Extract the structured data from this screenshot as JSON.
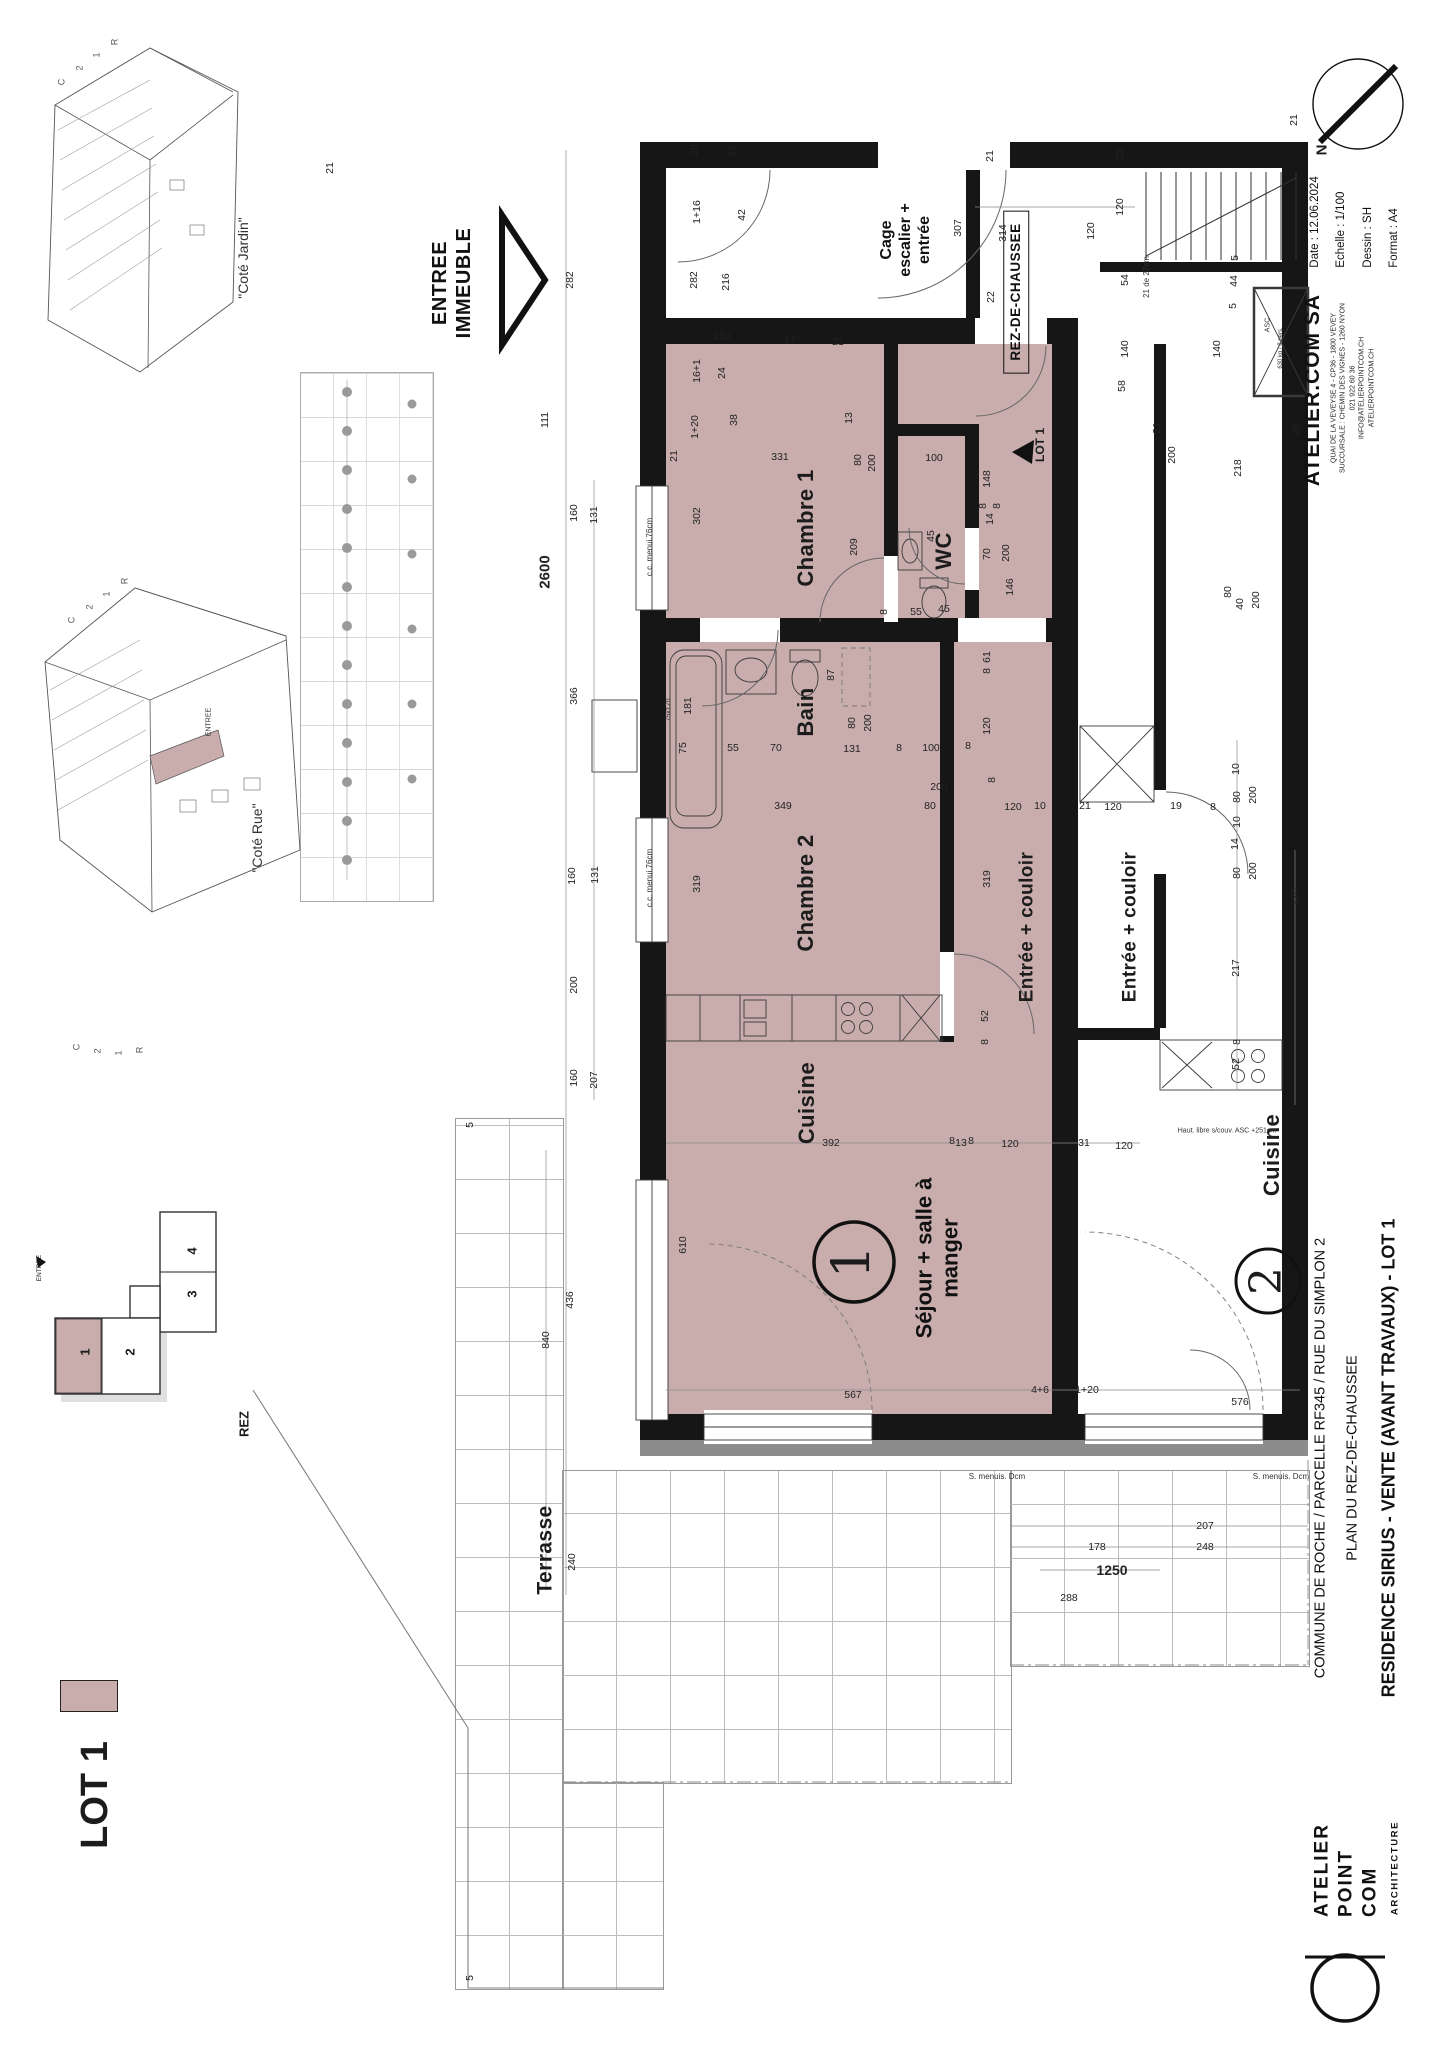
{
  "colors": {
    "lot": "#c9adad",
    "wall": "#161616",
    "band": "#8c8c8c"
  },
  "title_block": {
    "firm": "ATELIER.COM SA",
    "address_line1": "QUAI DE LA VEVEYSE 4 - CP36 - 1800 VEVEY",
    "address_line2": "SUCCURSALE : CHEMIN DES VIGNES - 1260 NYON",
    "address_line3": "021 922 60 36",
    "address_line4": "INFO@ATELIERPOINTCOM.CH",
    "address_line5": "ATELIERPOINTCOM.CH",
    "date": "Date : 12.06.2024",
    "scale": "Echelle : 1/100",
    "drawn": "Dessin : SH",
    "format": "Format : A4"
  },
  "project": {
    "line1": "COMMUNE DE ROCHE / PARCELLE RF345 / RUE DU SIMPLON 2",
    "line2": "PLAN DU REZ-DE-CHAUSSEE",
    "line3": "RESIDENCE SIRIUS  -  VENTE (AVANT TRAVAUX) - LOT 1"
  },
  "logo": {
    "line1": "ATELIER",
    "line2": "POINT",
    "line3": "COM",
    "sub": "ARCHITECTURE"
  },
  "plan": {
    "level_box": "REZ-DE-CHAUSSEE",
    "cage_line1": "Cage",
    "cage_line2": "escalier +",
    "cage_line3": "entrée",
    "sejour_line1": "Séjour + salle à",
    "sejour_line2": "manger",
    "entrance_line1": "ENTREE",
    "entrance_line2": "IMMEUBLE"
  },
  "labels": {
    "rooms": [
      {
        "t": "Chambre 1",
        "x": 806,
        "y": 528
      },
      {
        "t": "WC",
        "x": 944,
        "y": 551
      },
      {
        "t": "Bain",
        "x": 806,
        "y": 712
      },
      {
        "t": "Chambre 2",
        "x": 806,
        "y": 893
      },
      {
        "t": "Entrée + couloir",
        "x": 1027,
        "y": 927,
        "s": 19
      },
      {
        "t": "Entrée + couloir",
        "x": 1130,
        "y": 927,
        "s": 19
      },
      {
        "t": "Cuisine",
        "x": 807,
        "y": 1103
      },
      {
        "t": "Cuisine",
        "x": 1272,
        "y": 1155
      },
      {
        "t": "Terrasse",
        "x": 545,
        "y": 1550,
        "s": 21
      }
    ],
    "views": [
      {
        "t": "\"Coté Jardin\"",
        "x": 243,
        "y": 258
      },
      {
        "t": "\"Coté Rue\"",
        "x": 257,
        "y": 838
      },
      {
        "t": "ENTREE",
        "x": 209,
        "y": 722,
        "s": 7
      }
    ],
    "marks": [
      {
        "t": "C",
        "x": 62,
        "y": 82
      },
      {
        "t": "2",
        "x": 80,
        "y": 68
      },
      {
        "t": "1",
        "x": 97,
        "y": 55
      },
      {
        "t": "R",
        "x": 115,
        "y": 42
      },
      {
        "t": "C",
        "x": 72,
        "y": 620
      },
      {
        "t": "2",
        "x": 90,
        "y": 607
      },
      {
        "t": "1",
        "x": 107,
        "y": 594
      },
      {
        "t": "R",
        "x": 125,
        "y": 581
      },
      {
        "t": "C",
        "x": 77,
        "y": 1047
      },
      {
        "t": "2",
        "x": 98,
        "y": 1051
      },
      {
        "t": "1",
        "x": 119,
        "y": 1053
      },
      {
        "t": "R",
        "x": 140,
        "y": 1050
      }
    ],
    "keyplan": [
      {
        "t": "4",
        "x": 192,
        "y": 1251,
        "b": 1,
        "s": 13
      },
      {
        "t": "3",
        "x": 192,
        "y": 1294,
        "b": 1,
        "s": 13
      },
      {
        "t": "2",
        "x": 130,
        "y": 1352,
        "b": 1,
        "s": 13
      },
      {
        "t": "1",
        "x": 85,
        "y": 1352,
        "b": 1,
        "s": 13
      },
      {
        "t": "REZ",
        "x": 244,
        "y": 1424,
        "b": 1,
        "s": 13
      },
      {
        "t": "ENTREE",
        "x": 40,
        "y": 1268,
        "s": 6.5
      }
    ],
    "units": [
      {
        "t": "1",
        "x": 852,
        "y": 1262,
        "s": 52
      },
      {
        "t": "2",
        "x": 1267,
        "y": 1281,
        "s": 44
      }
    ],
    "tags": [
      {
        "t": "LOT 1",
        "x": 1040,
        "y": 445,
        "s": 12
      },
      {
        "t": "LOT 1",
        "x": 95,
        "y": 1795,
        "s": 38
      },
      {
        "t": "N",
        "x": 1322,
        "y": 150,
        "s": 15
      }
    ],
    "notes": [
      {
        "t": "c.c. menui.76cm",
        "x": 650,
        "y": 547
      },
      {
        "t": "c.c. menui.76cm",
        "x": 650,
        "y": 878
      },
      {
        "t": "75x170",
        "x": 669,
        "y": 710,
        "s": 7
      },
      {
        "t": "S. menuis. Dcm",
        "x": 997,
        "y": 1477,
        "h": 1
      },
      {
        "t": "S. menuis. Dcm",
        "x": 1281,
        "y": 1477,
        "h": 1
      },
      {
        "t": "Haut. libre s/couv. ASC +251cm",
        "x": 1227,
        "y": 1131,
        "s": 7,
        "h": 1
      },
      {
        "t": "21 de 27cm",
        "x": 1147,
        "y": 277
      },
      {
        "t": "ASC",
        "x": 1268,
        "y": 325,
        "s": 7
      },
      {
        "t": "630 kg / 8 pers.",
        "x": 1281,
        "y": 348,
        "s": 6
      }
    ],
    "dims": [
      {
        "t": "21",
        "x": 330,
        "y": 168
      },
      {
        "t": "282",
        "x": 570,
        "y": 280
      },
      {
        "t": "111",
        "x": 545,
        "y": 420
      },
      {
        "t": "160",
        "x": 574,
        "y": 513
      },
      {
        "t": "131",
        "x": 594,
        "y": 515
      },
      {
        "t": "366",
        "x": 574,
        "y": 696
      },
      {
        "t": "160",
        "x": 572,
        "y": 876
      },
      {
        "t": "131",
        "x": 595,
        "y": 875
      },
      {
        "t": "200",
        "x": 574,
        "y": 985
      },
      {
        "t": "160",
        "x": 574,
        "y": 1078
      },
      {
        "t": "207",
        "x": 594,
        "y": 1080
      },
      {
        "t": "436",
        "x": 570,
        "y": 1300
      },
      {
        "t": "840",
        "x": 546,
        "y": 1340
      },
      {
        "t": "2600",
        "x": 545,
        "y": 572,
        "b": 1,
        "s": 15
      },
      {
        "t": "240",
        "x": 572,
        "y": 1562
      },
      {
        "t": "5",
        "x": 470,
        "y": 1125
      },
      {
        "t": "5",
        "x": 470,
        "y": 1978
      },
      {
        "t": "20",
        "x": 694,
        "y": 150
      },
      {
        "t": "37",
        "x": 733,
        "y": 151
      },
      {
        "t": "1+16",
        "x": 697,
        "y": 212
      },
      {
        "t": "42",
        "x": 742,
        "y": 215
      },
      {
        "t": "282",
        "x": 694,
        "y": 280
      },
      {
        "t": "216",
        "x": 726,
        "y": 282
      },
      {
        "t": "250",
        "x": 722,
        "y": 336,
        "h": 1
      },
      {
        "t": "17",
        "x": 790,
        "y": 340,
        "h": 1
      },
      {
        "t": "21",
        "x": 838,
        "y": 342,
        "h": 1
      },
      {
        "t": "16+1",
        "x": 697,
        "y": 371
      },
      {
        "t": "24",
        "x": 722,
        "y": 373
      },
      {
        "t": "307",
        "x": 958,
        "y": 228
      },
      {
        "t": "314",
        "x": 1003,
        "y": 233
      },
      {
        "t": "22",
        "x": 991,
        "y": 297
      },
      {
        "t": "21",
        "x": 990,
        "y": 156
      },
      {
        "t": "21",
        "x": 1120,
        "y": 154
      },
      {
        "t": "120",
        "x": 1120,
        "y": 207
      },
      {
        "t": "120",
        "x": 1091,
        "y": 231
      },
      {
        "t": "54",
        "x": 1125,
        "y": 280
      },
      {
        "t": "44",
        "x": 1234,
        "y": 281
      },
      {
        "t": "5",
        "x": 1235,
        "y": 258
      },
      {
        "t": "5",
        "x": 1233,
        "y": 306
      },
      {
        "t": "140",
        "x": 1125,
        "y": 349
      },
      {
        "t": "140",
        "x": 1217,
        "y": 349
      },
      {
        "t": "21",
        "x": 1294,
        "y": 120
      },
      {
        "t": "26",
        "x": 1296,
        "y": 429
      },
      {
        "t": "31",
        "x": 1157,
        "y": 428
      },
      {
        "t": "58",
        "x": 1122,
        "y": 386
      },
      {
        "t": "200",
        "x": 1172,
        "y": 455
      },
      {
        "t": "218",
        "x": 1238,
        "y": 468
      },
      {
        "t": "80",
        "x": 1228,
        "y": 592
      },
      {
        "t": "40",
        "x": 1240,
        "y": 604
      },
      {
        "t": "200",
        "x": 1256,
        "y": 600
      },
      {
        "t": "1+20",
        "x": 695,
        "y": 427
      },
      {
        "t": "38",
        "x": 734,
        "y": 420
      },
      {
        "t": "21",
        "x": 674,
        "y": 456
      },
      {
        "t": "302",
        "x": 697,
        "y": 516
      },
      {
        "t": "331",
        "x": 780,
        "y": 457,
        "h": 1
      },
      {
        "t": "209",
        "x": 854,
        "y": 547
      },
      {
        "t": "13",
        "x": 849,
        "y": 418
      },
      {
        "t": "80",
        "x": 858,
        "y": 460
      },
      {
        "t": "200",
        "x": 872,
        "y": 463
      },
      {
        "t": "8",
        "x": 884,
        "y": 612
      },
      {
        "t": "100",
        "x": 934,
        "y": 458,
        "h": 1
      },
      {
        "t": "148",
        "x": 987,
        "y": 479
      },
      {
        "t": "8",
        "x": 983,
        "y": 506
      },
      {
        "t": "14",
        "x": 990,
        "y": 519
      },
      {
        "t": "8",
        "x": 997,
        "y": 506
      },
      {
        "t": "45",
        "x": 931,
        "y": 536
      },
      {
        "t": "55",
        "x": 916,
        "y": 612,
        "h": 1
      },
      {
        "t": "45",
        "x": 944,
        "y": 609,
        "h": 1
      },
      {
        "t": "70",
        "x": 987,
        "y": 554
      },
      {
        "t": "200",
        "x": 1006,
        "y": 553
      },
      {
        "t": "146",
        "x": 1010,
        "y": 587
      },
      {
        "t": "181",
        "x": 688,
        "y": 706
      },
      {
        "t": "75",
        "x": 683,
        "y": 748
      },
      {
        "t": "55",
        "x": 733,
        "y": 748,
        "h": 1
      },
      {
        "t": "70",
        "x": 776,
        "y": 748,
        "h": 1
      },
      {
        "t": "87",
        "x": 831,
        "y": 675
      },
      {
        "t": "80",
        "x": 852,
        "y": 723
      },
      {
        "t": "200",
        "x": 868,
        "y": 723
      },
      {
        "t": "131",
        "x": 852,
        "y": 749,
        "h": 1
      },
      {
        "t": "8",
        "x": 899,
        "y": 748,
        "h": 1
      },
      {
        "t": "100",
        "x": 931,
        "y": 748,
        "h": 1
      },
      {
        "t": "8",
        "x": 968,
        "y": 746,
        "h": 1
      },
      {
        "t": "120",
        "x": 987,
        "y": 726
      },
      {
        "t": "200",
        "x": 939,
        "y": 787,
        "h": 1
      },
      {
        "t": "80",
        "x": 930,
        "y": 806,
        "h": 1
      },
      {
        "t": "8",
        "x": 992,
        "y": 780
      },
      {
        "t": "61",
        "x": 987,
        "y": 657
      },
      {
        "t": "8",
        "x": 987,
        "y": 671
      },
      {
        "t": "349",
        "x": 783,
        "y": 806,
        "h": 1
      },
      {
        "t": "319",
        "x": 697,
        "y": 884
      },
      {
        "t": "319",
        "x": 987,
        "y": 879
      },
      {
        "t": "52",
        "x": 985,
        "y": 1016
      },
      {
        "t": "8",
        "x": 985,
        "y": 1042
      },
      {
        "t": "120",
        "x": 1013,
        "y": 807,
        "h": 1
      },
      {
        "t": "10",
        "x": 1040,
        "y": 806,
        "h": 1
      },
      {
        "t": "21",
        "x": 1085,
        "y": 806,
        "h": 1
      },
      {
        "t": "120",
        "x": 1113,
        "y": 807,
        "h": 1
      },
      {
        "t": "19",
        "x": 1176,
        "y": 806,
        "h": 1
      },
      {
        "t": "8",
        "x": 1213,
        "y": 807,
        "h": 1
      },
      {
        "t": "120",
        "x": 1295,
        "y": 897
      },
      {
        "t": "10",
        "x": 1236,
        "y": 769
      },
      {
        "t": "80",
        "x": 1237,
        "y": 797
      },
      {
        "t": "200",
        "x": 1253,
        "y": 795
      },
      {
        "t": "10",
        "x": 1237,
        "y": 822
      },
      {
        "t": "14",
        "x": 1235,
        "y": 844
      },
      {
        "t": "80",
        "x": 1237,
        "y": 873
      },
      {
        "t": "200",
        "x": 1253,
        "y": 871
      },
      {
        "t": "217",
        "x": 1236,
        "y": 968
      },
      {
        "t": "52",
        "x": 1236,
        "y": 1064
      },
      {
        "t": "8",
        "x": 1237,
        "y": 1042
      },
      {
        "t": "392",
        "x": 831,
        "y": 1143,
        "h": 1
      },
      {
        "t": "8",
        "x": 952,
        "y": 1141,
        "h": 1
      },
      {
        "t": "13",
        "x": 961,
        "y": 1143,
        "h": 1
      },
      {
        "t": "8",
        "x": 971,
        "y": 1141,
        "h": 1
      },
      {
        "t": "120",
        "x": 1010,
        "y": 1144,
        "h": 1
      },
      {
        "t": "31",
        "x": 1084,
        "y": 1143,
        "h": 1
      },
      {
        "t": "120",
        "x": 1124,
        "y": 1146,
        "h": 1
      },
      {
        "t": "610",
        "x": 683,
        "y": 1245
      },
      {
        "t": "567",
        "x": 853,
        "y": 1395,
        "h": 1
      },
      {
        "t": "4+6",
        "x": 1040,
        "y": 1390,
        "h": 1
      },
      {
        "t": "1+20",
        "x": 1087,
        "y": 1390,
        "h": 1
      },
      {
        "t": "576",
        "x": 1240,
        "y": 1402,
        "h": 1
      },
      {
        "t": "207",
        "x": 1205,
        "y": 1526,
        "h": 1
      },
      {
        "t": "248",
        "x": 1205,
        "y": 1547,
        "h": 1
      },
      {
        "t": "178",
        "x": 1097,
        "y": 1547,
        "h": 1
      },
      {
        "t": "288",
        "x": 1069,
        "y": 1598,
        "h": 1
      },
      {
        "t": "1250",
        "x": 1112,
        "y": 1570,
        "h": 1,
        "b": 1,
        "s": 14
      }
    ]
  }
}
